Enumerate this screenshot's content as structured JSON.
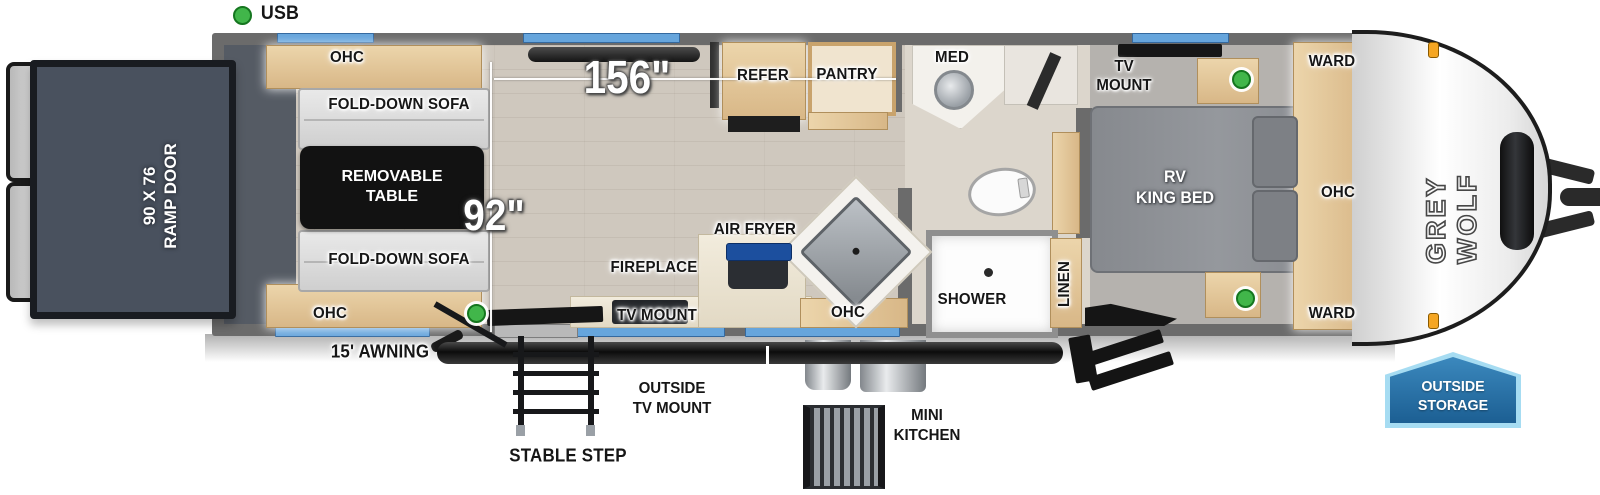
{
  "legend": {
    "usb": "USB"
  },
  "dimensions": {
    "living_length": "156\"",
    "garage_width": "92\""
  },
  "ramp_door": {
    "line1": "90 X 76",
    "line2": "RAMP DOOR"
  },
  "garage": {
    "ohc_top": "OHC",
    "sofa_top": "FOLD-DOWN SOFA",
    "table_line1": "REMOVABLE",
    "table_line2": "TABLE",
    "sofa_bottom": "FOLD-DOWN SOFA",
    "ohc_bottom": "OHC"
  },
  "kitchen": {
    "refer": "REFER",
    "pantry": "PANTRY",
    "fireplace": "FIREPLACE",
    "air_fryer": "AIR FRYER",
    "ohc": "OHC",
    "tv_mount": "TV MOUNT"
  },
  "bath": {
    "med": "MED",
    "shower": "SHOWER",
    "linen": "LINEN"
  },
  "bedroom": {
    "tv_mount_line1": "TV",
    "tv_mount_line2": "MOUNT",
    "bed_line1": "RV",
    "bed_line2": "KING BED",
    "ward_top": "WARD",
    "ohc": "OHC",
    "ward_bottom": "WARD"
  },
  "exterior": {
    "brand": "GREY WOLF",
    "awning": "15' AWNING",
    "stable_step": "STABLE STEP",
    "outside_tv_line1": "OUTSIDE",
    "outside_tv_line2": "TV MOUNT",
    "mini_kitchen_line1": "MINI",
    "mini_kitchen_line2": "KITCHEN",
    "storage_line1": "OUTSIDE",
    "storage_line2": "STORAGE"
  },
  "colors": {
    "wall_gray": "#6b6b6b",
    "window_blue": "#66a5dc",
    "usb_green": "#41b64a",
    "ramp_slate": "#49515e",
    "table_black": "#121212",
    "wood_tan": "#e0c49a",
    "bed_gray": "#8f9296",
    "badge_blue": "#1c5f93",
    "badge_border": "#a6dcf2",
    "marker_orange": "#f5a623"
  }
}
